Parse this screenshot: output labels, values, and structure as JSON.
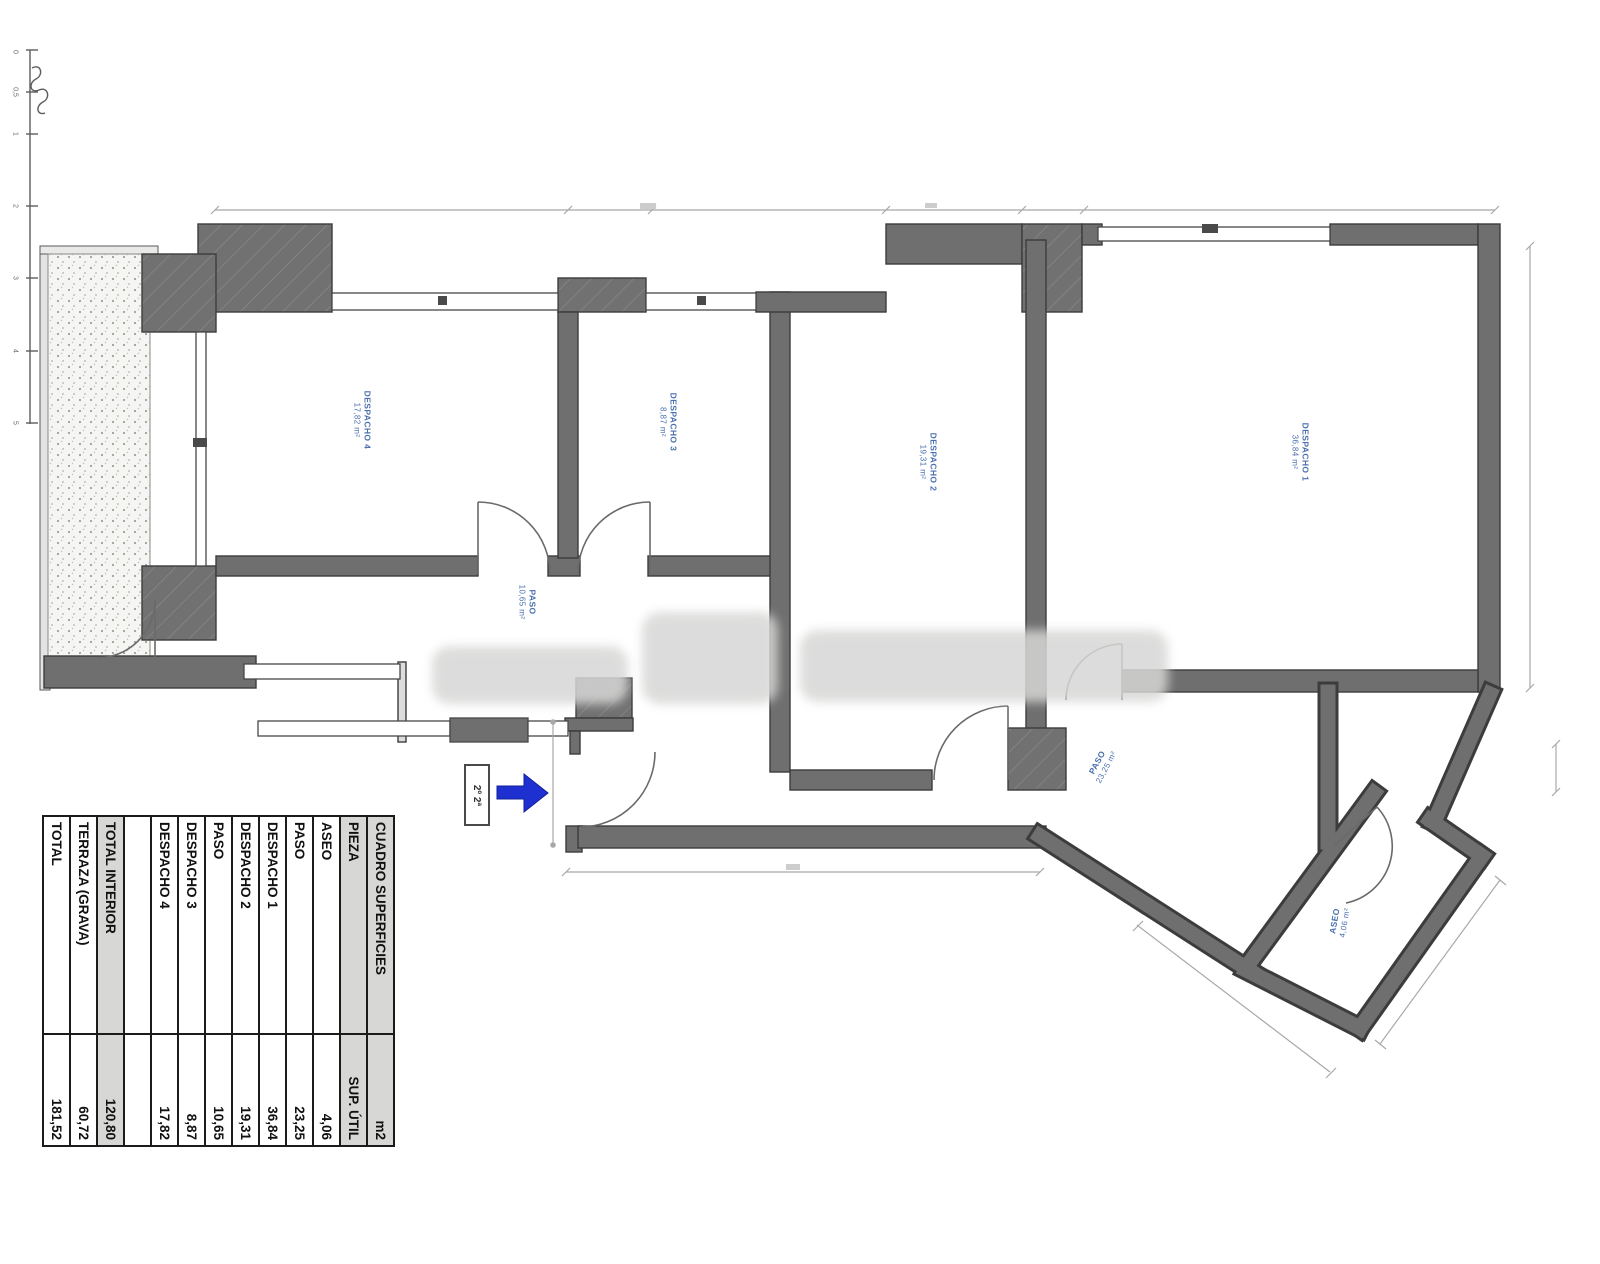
{
  "plan": {
    "unit_label": "2º 2ª",
    "label_color": "#4a6fae",
    "arrow_color": "#1e31d0",
    "scale_ticks": [
      "0",
      "0,5",
      "1",
      "2",
      "3",
      "4",
      "5"
    ],
    "rooms": [
      {
        "id": "despacho4",
        "name": "DESPACHO 4",
        "area": "17,82 m²"
      },
      {
        "id": "despacho3",
        "name": "DESPACHO 3",
        "area": "8,87 m²"
      },
      {
        "id": "despacho2",
        "name": "DESPACHO 2",
        "area": "19,31 m²"
      },
      {
        "id": "despacho1",
        "name": "DESPACHO 1",
        "area": "36,84 m²"
      },
      {
        "id": "paso-hall",
        "name": "PASO",
        "area": "10,65 m²"
      },
      {
        "id": "paso-corridor",
        "name": "PASO",
        "area": "23,25 m²"
      },
      {
        "id": "aseo",
        "name": "ASEO",
        "area": "4,06 m²"
      }
    ]
  },
  "table": {
    "title": "CUADRO SUPERFICIES",
    "unit": "m2",
    "piece_header": "PIEZA",
    "sup_header": "SUP. ÚTIL",
    "rows": [
      {
        "label": "ASEO",
        "value": "4,06"
      },
      {
        "label": "PASO",
        "value": "23,25"
      },
      {
        "label": "DESPACHO 1",
        "value": "36,84"
      },
      {
        "label": "DESPACHO 2",
        "value": "19,31"
      },
      {
        "label": "PASO",
        "value": "10,65"
      },
      {
        "label": "DESPACHO 3",
        "value": "8,87"
      },
      {
        "label": "DESPACHO 4",
        "value": "17,82"
      }
    ],
    "totals": [
      {
        "label": "TOTAL INTERIOR",
        "value": "120,80",
        "shaded": true
      },
      {
        "label": "TERRAZA (GRAVA)",
        "value": "60,72",
        "shaded": false
      },
      {
        "label": "TOTAL",
        "value": "181,52",
        "shaded": false
      }
    ]
  }
}
